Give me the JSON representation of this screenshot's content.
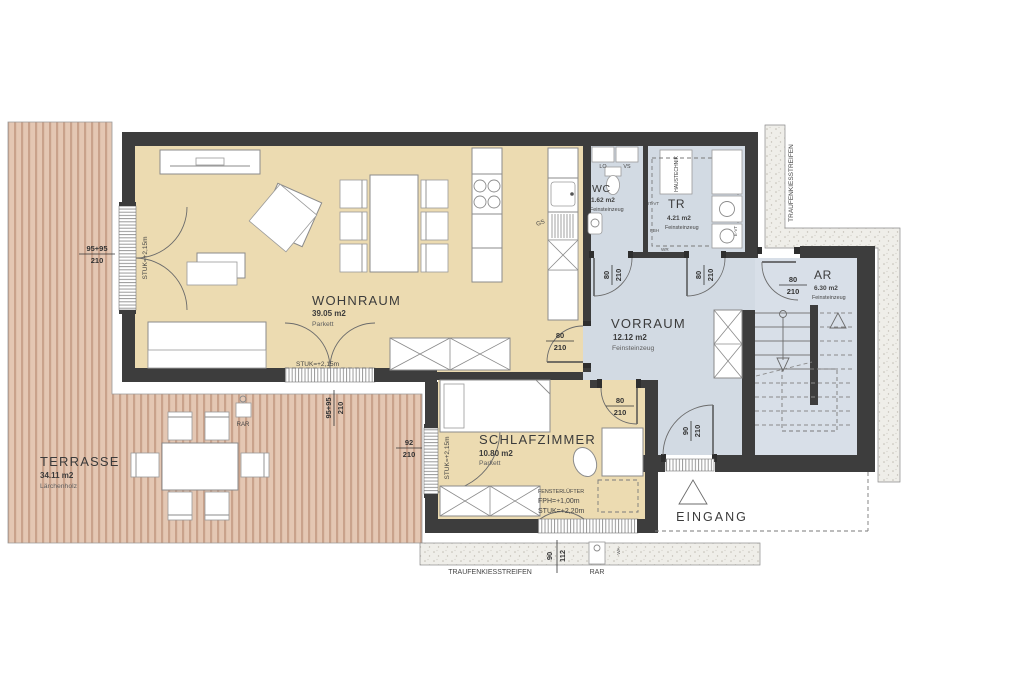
{
  "plan": {
    "rooms": {
      "wohnraum": {
        "name": "WOHNRAUM",
        "area": "39.05 m2",
        "floor": "Parkett"
      },
      "schlafzimmer": {
        "name": "SCHLAFZIMMER",
        "area": "10.80 m2",
        "floor": "Parkett"
      },
      "vorraum": {
        "name": "VORRAUM",
        "area": "12.12 m2",
        "floor": "Feinsteinzeug"
      },
      "wc": {
        "name": "WC",
        "area": "1.62 m2",
        "floor": "Feinsteinzeug"
      },
      "tr": {
        "name": "TR",
        "area": "4.21 m2",
        "floor": "Feinsteinzeug"
      },
      "ar": {
        "name": "AR",
        "area": "6.30 m2",
        "floor": "Feinsteinzeug"
      },
      "terrasse": {
        "name": "TERRASSE",
        "area": "34.11 m2",
        "floor": "Lärchenholz"
      },
      "eingang": {
        "name": "EINGANG"
      }
    },
    "annotations": {
      "stuk215": "STUK=+2,15m",
      "stuk220": "STUK=+2,20m",
      "fph": "FPH=+1,00m",
      "fensterluefter": "FENSTERLÜFTER",
      "haustechnik": "HAUSTECHNIK",
      "traufenkiesstreifen": "TRAUFENKIESSTREIFEN",
      "rar": "RAR",
      "wa": "WA",
      "lo": "LO",
      "vs": "VS",
      "gs": "GS",
      "wr": "WR",
      "fbh": "FBH",
      "itvt": "IT-VT",
      "evt": "E-VT"
    },
    "dimensions": {
      "door_w": "80",
      "door_h": "210",
      "entrance_door_w": "90",
      "terrace_door_w": "95+95",
      "bedroom_window_w": "92",
      "bottom_window_a": "90",
      "bottom_window_b": "112"
    },
    "colors": {
      "wall": "#3d3d3d",
      "floor_living": "#ecdbb1",
      "floor_wet": "#d2dae3",
      "deck": "#e4c7b3",
      "deck_stripe": "#c9a28b",
      "gravel": "#efeee9"
    }
  }
}
